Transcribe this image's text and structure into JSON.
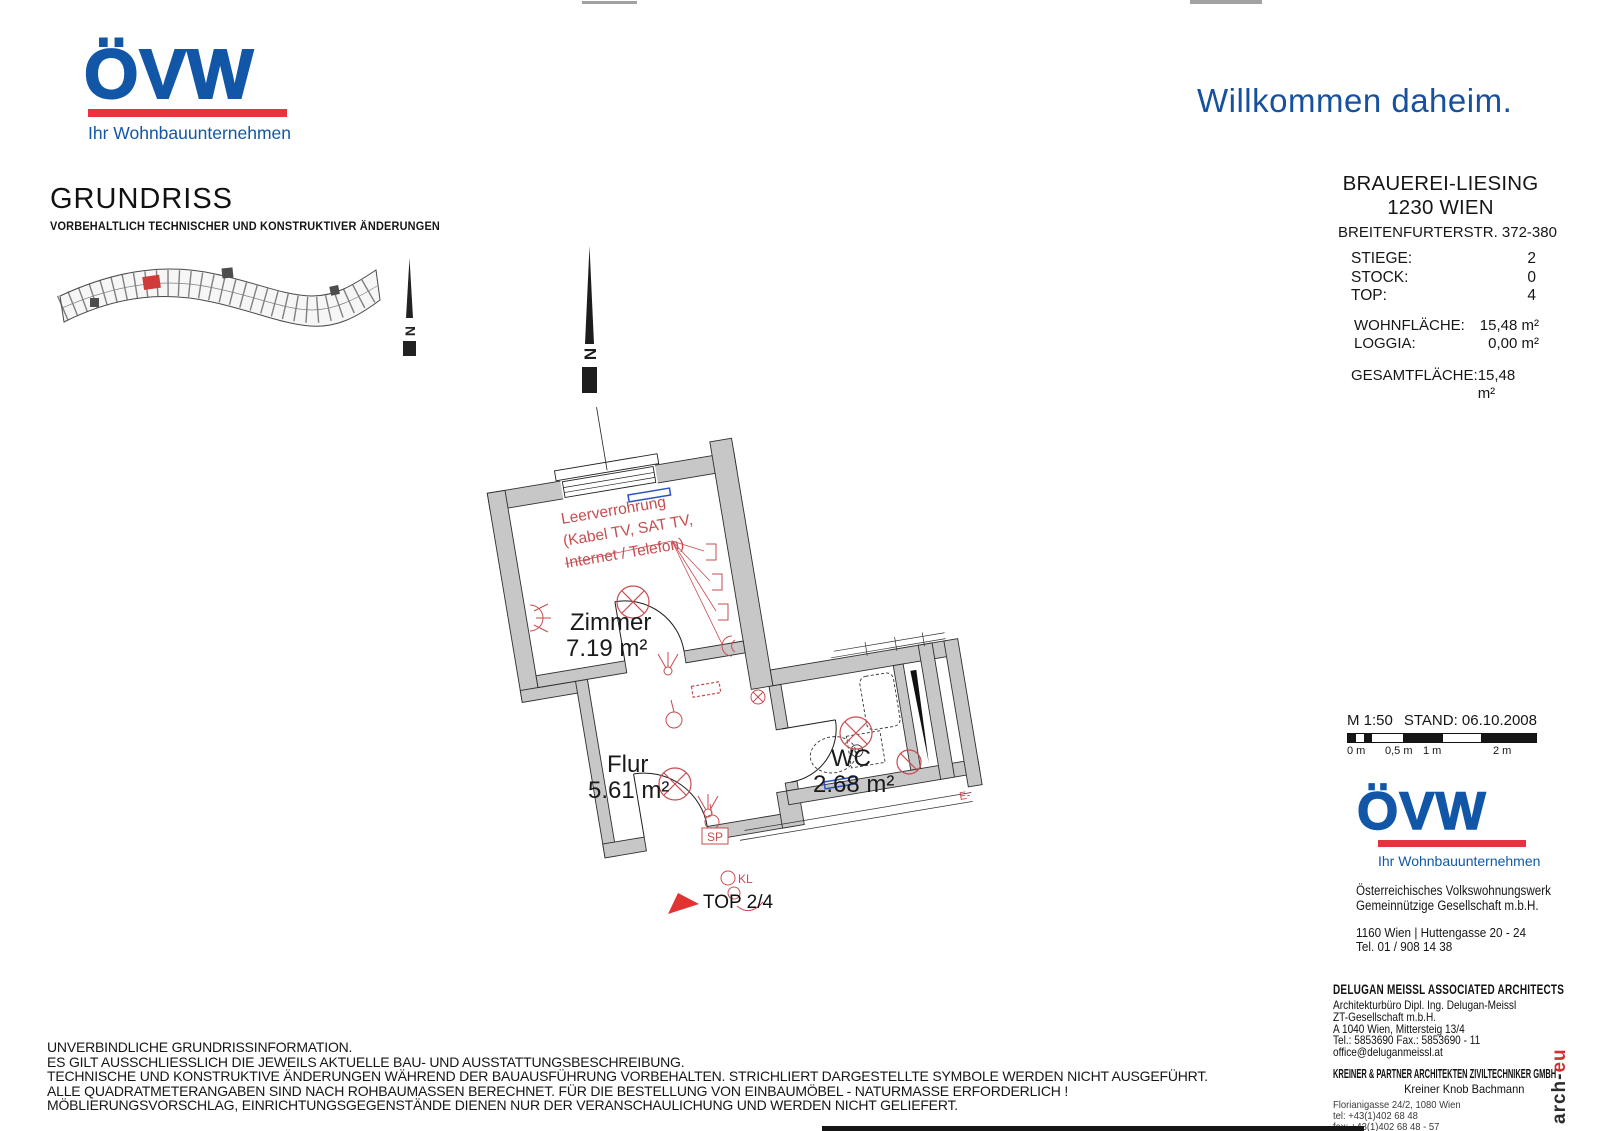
{
  "colors": {
    "brand_blue": "#1257a7",
    "brand_red": "#e8333f",
    "welcome_blue": "#17519e",
    "plan_red": "#c64c50",
    "wall_gray": "#c7c7c7",
    "blue_mark": "#2a52c0"
  },
  "header": {
    "logo": {
      "text": "ÖVW",
      "tagline": "Ihr Wohnbauunternehmen"
    },
    "title": "GRUNDRISS",
    "subtitle": "VORBEHALTLICH TECHNISCHER UND KONSTRUKTIVER ÄNDERUNGEN",
    "welcome": "Willkommen daheim."
  },
  "project": {
    "name": "BRAUEREI-LIESING",
    "city": "1230 WIEN",
    "street": "BREITENFURTERSTR. 372-380",
    "rows": [
      {
        "label": "STIEGE:",
        "value": "2"
      },
      {
        "label": "STOCK:",
        "value": "0"
      },
      {
        "label": "TOP:",
        "value": "4"
      }
    ],
    "areas": [
      {
        "label": "WOHNFLÄCHE:",
        "value": "15,48 m²"
      },
      {
        "label": "LOGGIA:",
        "value": "0,00 m²"
      }
    ],
    "total": {
      "label": "GESAMTFLÄCHE:",
      "value": "15,48 m²"
    }
  },
  "plan": {
    "rooms": [
      {
        "name": "Zimmer",
        "area": "7.19 m²"
      },
      {
        "name": "Flur",
        "area": "5.61 m²"
      },
      {
        "name": "WC",
        "area": "2.68 m²"
      }
    ],
    "leerverrohrung": [
      "Leerverrohrung",
      "(Kabel TV, SAT TV,",
      "Internet / Telefon)"
    ],
    "top_label": "TOP 2/4",
    "sp_label": "SP",
    "kl_label": "KL",
    "e_label": "E-",
    "north_label": "N"
  },
  "scale": {
    "ratio": "M 1:50",
    "stand": "STAND: 06.10.2008",
    "ticks": [
      "0 m",
      "0,5 m",
      "1 m",
      "2 m"
    ]
  },
  "footer": {
    "logo": {
      "text": "ÖVW",
      "tagline": "Ihr Wohnbauunternehmen"
    },
    "company": [
      "Österreichisches Volkswohnungswerk",
      "Gemeinnützige Gesellschaft m.b.H."
    ],
    "address": "1160 Wien | Huttengasse 20 - 24",
    "phone": "Tel. 01 / 908 14 38"
  },
  "architects": {
    "dm": {
      "name": "DELUGAN MEISSL ASSOCIATED ARCHITECTS",
      "lines": [
        "Architekturbüro Dipl. Ing. Delugan-Meissl",
        "ZT-Gesellschaft m.b.H.",
        "A 1040 Wien, Mittersteig 13/4",
        "Tel.: 5853690 Fax.: 5853690 - 11",
        "office@deluganmeissl.at"
      ]
    },
    "kp": {
      "name": "KREINER & PARTNER ARCHITEKTEN ZIVILTECHNIKER GMBH",
      "sub": "Kreiner Knob Bachmann",
      "lines": [
        "Florianigasse 24/2, 1080 Wien",
        "tel: +43(1)402 68 48",
        "fax: +43(1)402 68 48 - 57",
        "email: office@arch-eu.com"
      ]
    },
    "side_black": "arch-",
    "side_red": "eu"
  },
  "disclaimer": [
    "UNVERBINDLICHE GRUNDRISSINFORMATION.",
    "ES GILT AUSSCHLIESSLICH DIE JEWEILS AKTUELLE BAU- UND AUSSTATTUNGSBESCHREIBUNG.",
    "TECHNISCHE UND KONSTRUKTIVE ÄNDERUNGEN WÄHREND DER BAUAUSFÜHRUNG VORBEHALTEN. STRICHLIERT DARGESTELLTE SYMBOLE WERDEN NICHT AUSGEFÜHRT.",
    "ALLE QUADRATMETERANGABEN SIND NACH ROHBAUMASSEN BERECHNET. FÜR DIE BESTELLUNG VON EINBAUMÖBEL - NATURMASSE ERFORDERLICH !",
    "MÖBLIERUNGSVORSCHLAG, EINRICHTUNGSGEGENSTÄNDE DIENEN NUR DER VERANSCHAULICHUNG UND WERDEN NICHT GELIEFERT."
  ]
}
